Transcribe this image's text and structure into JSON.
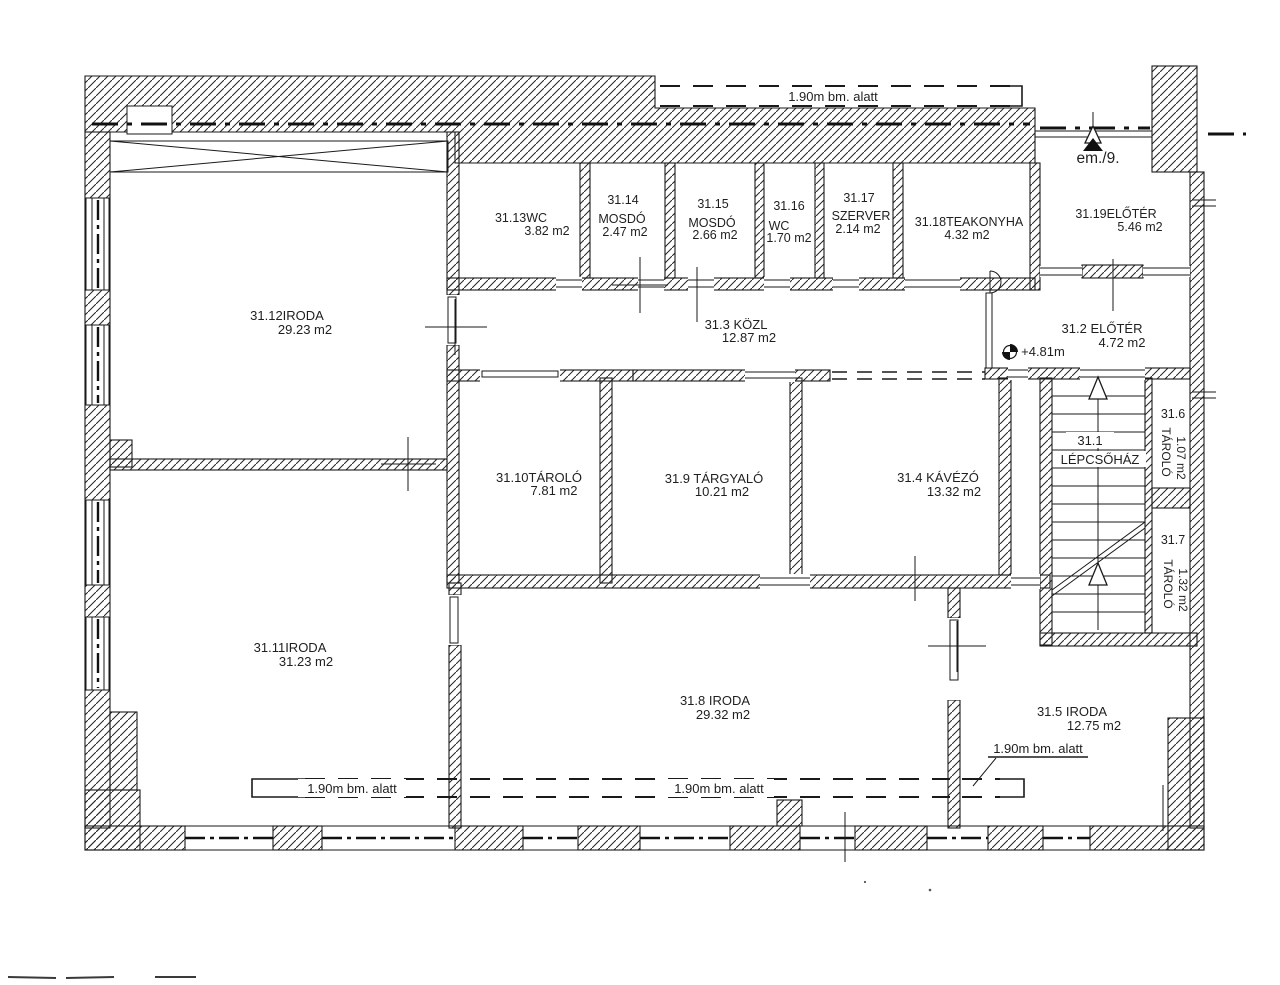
{
  "plan": {
    "drawing_type": "floor-plan",
    "floor_reference": "em./9.",
    "colors": {
      "ink": "#1f1f1f",
      "paper": "#ffffff"
    }
  },
  "rooms": {
    "r31_1": {
      "l1": "31.1",
      "l2": "LÉPCSŐHÁZ"
    },
    "r31_2": {
      "l1": "31.2 ELŐTÉR",
      "l2": "4.72 m2"
    },
    "r31_3": {
      "l1": "31.3 KÖZL",
      "l2": "12.87 m2"
    },
    "r31_4": {
      "l1": "31.4 KÁVÉZÓ",
      "l2": "13.32 m2"
    },
    "r31_5": {
      "l1": "31.5 IRODA",
      "l2": "12.75 m2"
    },
    "r31_6": {
      "l1": "31.6",
      "l2": "TÁROLÓ",
      "l3": "1.07 m2"
    },
    "r31_7": {
      "l1": "31.7",
      "l2": "TÁROLÓ",
      "l3": "1.32 m2"
    },
    "r31_8": {
      "l1": "31.8 IRODA",
      "l2": "29.32 m2"
    },
    "r31_9": {
      "l1": "31.9 TÁRGYALÓ",
      "l2": "10.21 m2"
    },
    "r31_10": {
      "l1": "31.10TÁROLÓ",
      "l2": "7.81 m2"
    },
    "r31_11": {
      "l1": "31.11IRODA",
      "l2": "31.23 m2"
    },
    "r31_12": {
      "l1": "31.12IRODA",
      "l2": "29.23 m2"
    },
    "r31_13": {
      "l1": "31.13WC",
      "l2": "3.82 m2"
    },
    "r31_14": {
      "l1": "31.14",
      "l2": "MOSDÓ",
      "l3": "2.47 m2"
    },
    "r31_15": {
      "l1": "31.15",
      "l2": "MOSDÓ",
      "l3": "2.66 m2"
    },
    "r31_16": {
      "l1": "31.16",
      "l2": "WC",
      "l3": "1.70 m2"
    },
    "r31_17": {
      "l1": "31.17",
      "l2": "SZERVER",
      "l3": "2.14 m2"
    },
    "r31_18": {
      "l1": "31.18TEAKONYHA",
      "l2": "4.32 m2"
    },
    "r31_19": {
      "l1": "31.19ELŐTÉR",
      "l2": "5.46 m2"
    }
  },
  "annotations": {
    "overhang_top": "1.90m bm. alatt",
    "overhang_bottom_left": "1.90m bm. alatt",
    "overhang_bottom_mid": "1.90m bm. alatt",
    "overhang_right": "1.90m bm. alatt",
    "entrance_label": "em./9.",
    "level_label": "+4.81m"
  }
}
